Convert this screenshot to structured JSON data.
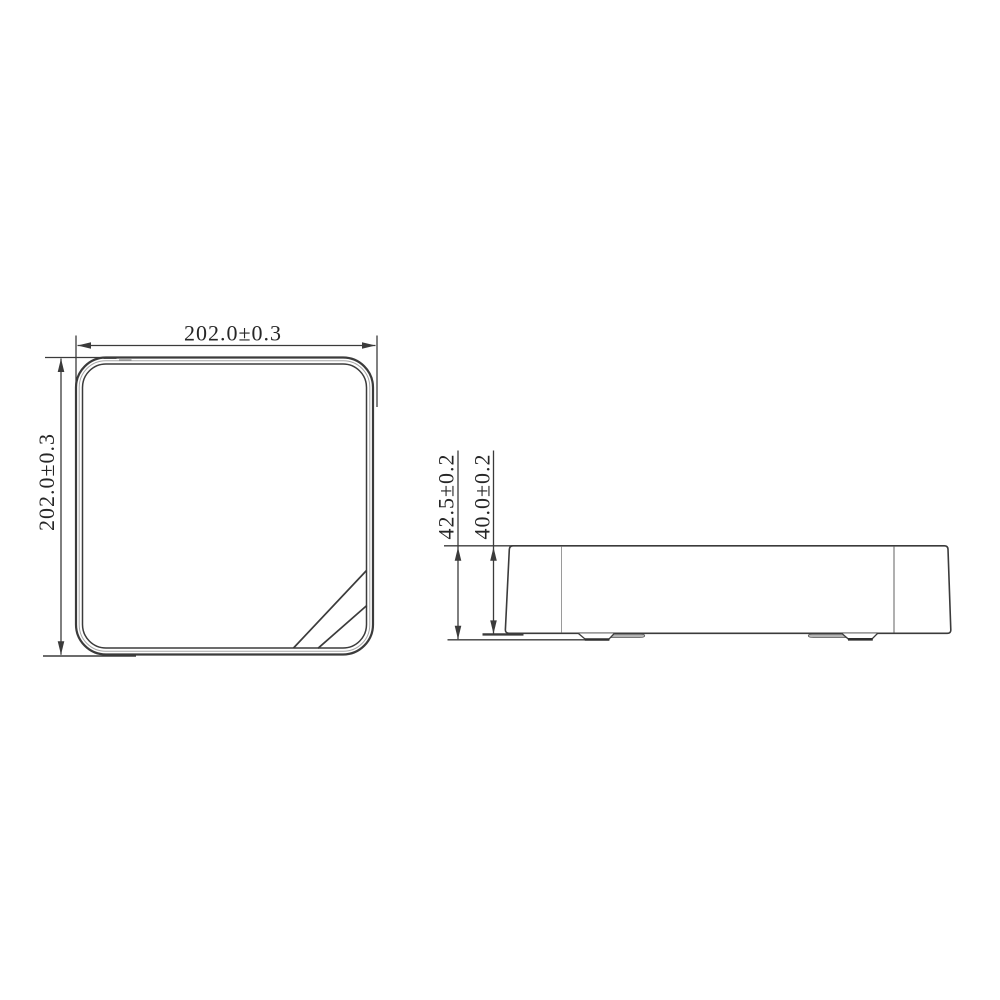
{
  "drawing": {
    "type": "technical-dimension-drawing",
    "views": {
      "top": {
        "name": "top view",
        "width_label": "202.0±0.3",
        "height_label": "202.0±0.3"
      },
      "side": {
        "name": "side view",
        "overall_height_label": "42.5±0.2",
        "body_height_label": "40.0±0.2"
      }
    },
    "colors": {
      "line": "#3b3b3b",
      "light_line": "#a6a6a6",
      "foot_fill": "#b3b3b3",
      "text": "#262626",
      "background": "#ffffff"
    }
  }
}
